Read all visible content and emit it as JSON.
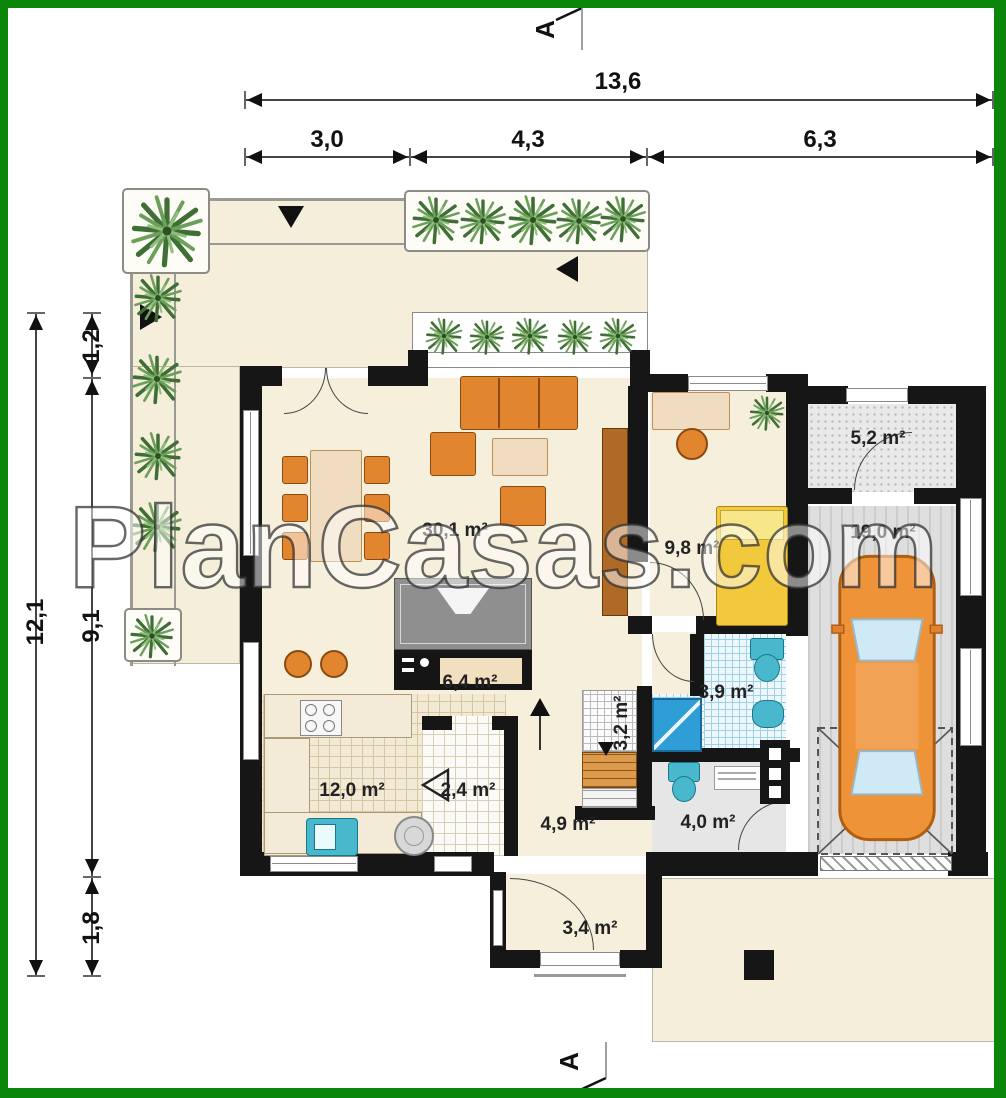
{
  "watermark": {
    "text": "PlanCasas.com"
  },
  "section_markers": {
    "top": "A",
    "bottom": "A"
  },
  "dimensions": {
    "horizontal": {
      "total": "13,6",
      "segments": [
        "3,0",
        "4,3",
        "6,3"
      ]
    },
    "vertical": {
      "total": "12,1",
      "segments": [
        "1,2",
        "9,1",
        "1,8"
      ]
    }
  },
  "rooms": {
    "living_dining": {
      "area": "30,1 m²"
    },
    "bedroom": {
      "area": "9,8 m²"
    },
    "storage": {
      "area": "5,2 m²"
    },
    "garage": {
      "area": "19,0 m²"
    },
    "hall": {
      "area": "6,4 m²"
    },
    "kitchen": {
      "area": "12,0 m²"
    },
    "pantry": {
      "area": "2,4 m²"
    },
    "stairs": {
      "area": "3,2 m²"
    },
    "hallway": {
      "area": "4,9 m²"
    },
    "bathroom": {
      "area": "3,9 m²"
    },
    "wc": {
      "area": "4,0 m²"
    },
    "vestibule": {
      "area": "3,4 m²"
    }
  },
  "colors": {
    "frame": "#0a870a",
    "walls": "#161616",
    "floor_cream": "#f6efdc",
    "furniture_orange": "#e2852f",
    "fixture_teal": "#49b8cc",
    "shower_blue": "#2f9ed6",
    "bed_yellow": "#f2c83c",
    "plant_green": "#4a7c3f"
  }
}
